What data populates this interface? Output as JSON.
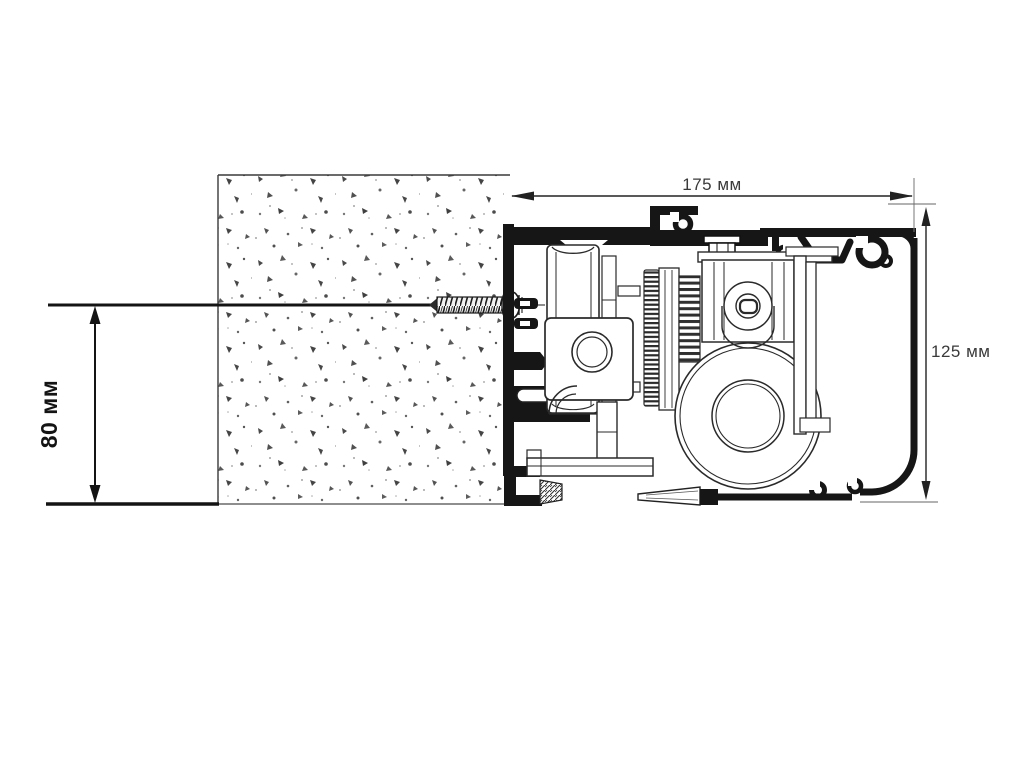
{
  "diagram": {
    "type": "technical-cross-section",
    "labels": {
      "top_width": "175 мм",
      "right_height": "125 мм",
      "left_height": "80 мм"
    },
    "values": {
      "top_width_mm": 175,
      "right_height_mm": 125,
      "left_height_mm": 80,
      "unit": "мм"
    },
    "colors": {
      "ink": "#161616",
      "line": "#2a2a2a",
      "dim_text": "#3a3a3a",
      "background": "#ffffff"
    }
  }
}
